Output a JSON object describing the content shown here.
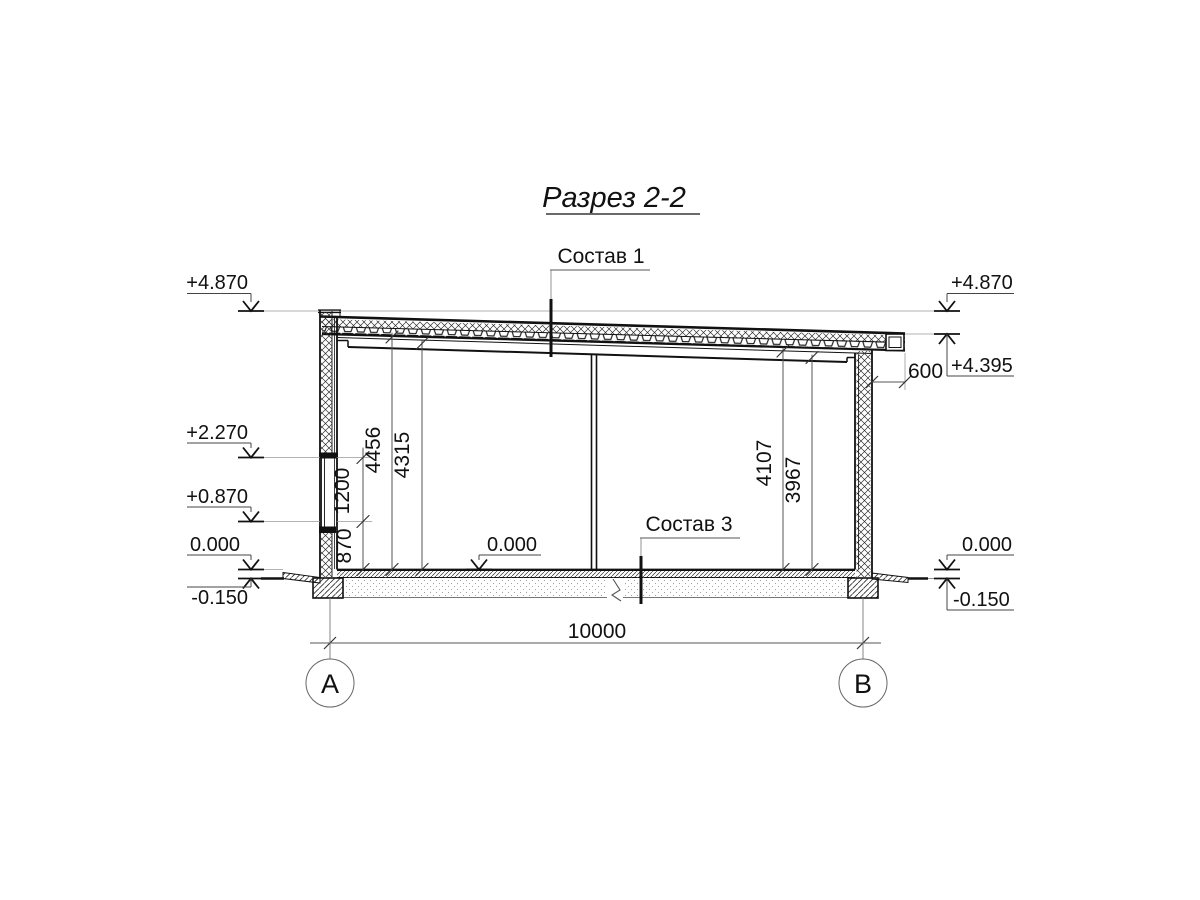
{
  "title": "Разрез 2-2",
  "leaders": {
    "sostav1": "Состав 1",
    "sostav3": "Состав 3"
  },
  "marks": {
    "left_top": "+4.870",
    "left_2270": "+2.270",
    "left_0870": "+0.870",
    "left_zero": "0.000",
    "left_minus": "-0.150",
    "center_zero": "0.000",
    "right_top": "+4.870",
    "right_4395": "+4.395",
    "right_zero": "0.000",
    "right_minus": "-0.150"
  },
  "dims": {
    "v870": "870",
    "v1200": "1200",
    "v4456": "4456",
    "v4315": "4315",
    "v4107": "4107",
    "v3967": "3967",
    "overhang": "600",
    "span": "10000"
  },
  "axes": {
    "left": "A",
    "right": "B"
  },
  "colors": {
    "line": "#1a1a1a",
    "thin": "#555555",
    "aux": "#888888",
    "paper": "#ffffff"
  }
}
